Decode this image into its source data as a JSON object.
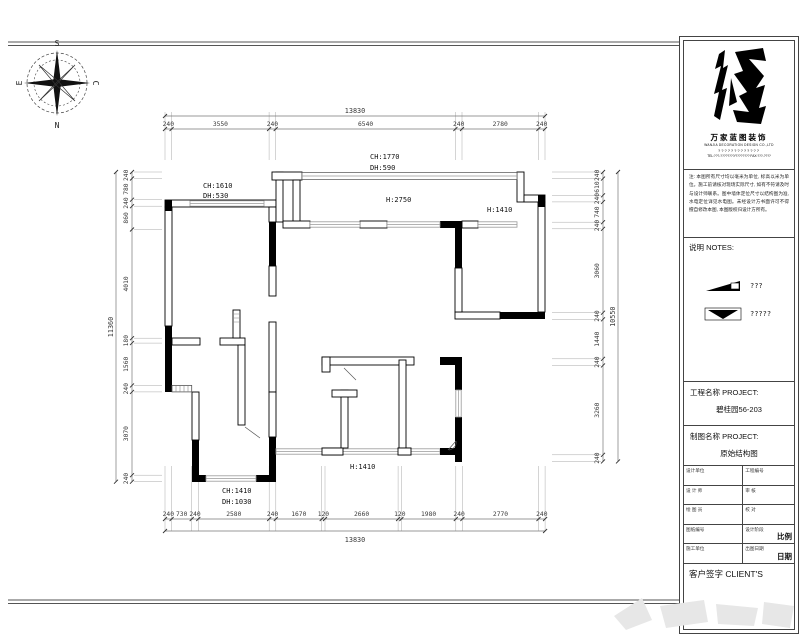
{
  "compass": {
    "top": "S",
    "bottom": "N",
    "left": "E",
    "right": "C"
  },
  "dims": {
    "top": {
      "total": "13830",
      "segments": [
        "240",
        "3550",
        "240",
        "6540",
        "240",
        "2780",
        "240"
      ]
    },
    "bottom": {
      "total": "13830",
      "segments": [
        "240",
        "730",
        "240",
        "2580",
        "240",
        "1670",
        "120",
        "2660",
        "120",
        "1980",
        "240",
        "2770",
        "240"
      ]
    },
    "left": {
      "total": "11360",
      "segments": [
        "240",
        "780",
        "240",
        "860",
        "4010",
        "180",
        "1560",
        "240",
        "3070",
        "240"
      ]
    },
    "right": {
      "total": "10550",
      "segments": [
        "240",
        "610",
        "240",
        "740",
        "240",
        "3060",
        "240",
        "1440",
        "240",
        "3260",
        "240"
      ]
    }
  },
  "labels": {
    "left_window_ch": "CH:1610",
    "left_window_dh": "DH:530",
    "top_window_ch": "CH:1770",
    "top_window_dh": "DH:590",
    "hall_height": "H:2750",
    "right_window_h": "H:1410",
    "bottom_window_h": "H:1410",
    "bl_window_ch": "CH:1410",
    "bl_window_dh": "DH:1030"
  },
  "titleblock": {
    "company_cn": "万家蓝图装饰",
    "company_en": "WANJIA DECORATION DESIGN CO.,LTD",
    "company_line3": "?????????????",
    "company_line4": "TEL:???-????????/????????   FAX:???-????",
    "notes": "注: 本图所有尺寸均以毫米为单位, 标高以米为单位。施工前请核对现场实际尺寸, 如有不符请及时与设计师联系。图中墙体定位尺寸以结构图为准, 水电定位详见水电图。未经设计方书面许可不得擅自修改本图, 本图版权归设计方所有。",
    "notes_header": "说明  NOTES:",
    "legend": [
      {
        "label": "???"
      },
      {
        "label": "?????"
      }
    ],
    "project_label": "工程名称 PROJECT:",
    "project_value": "碧桂园56-203",
    "drawing_label": "制图名称 PROJECT:",
    "drawing_value": "原始结构图",
    "table": {
      "rows": [
        {
          "left": "设计单位",
          "right": "工程编号"
        },
        {
          "left": "设 计 师",
          "right": "审  核"
        },
        {
          "left": "绘 图 员",
          "right": "校  对"
        },
        {
          "left": "图纸编号",
          "right": "设计阶段"
        },
        {
          "left": "施工单位",
          "right": "出图日期"
        }
      ],
      "big1": "比例",
      "big2": "日期"
    },
    "client_label": "客户签字 CLIENT'S"
  }
}
